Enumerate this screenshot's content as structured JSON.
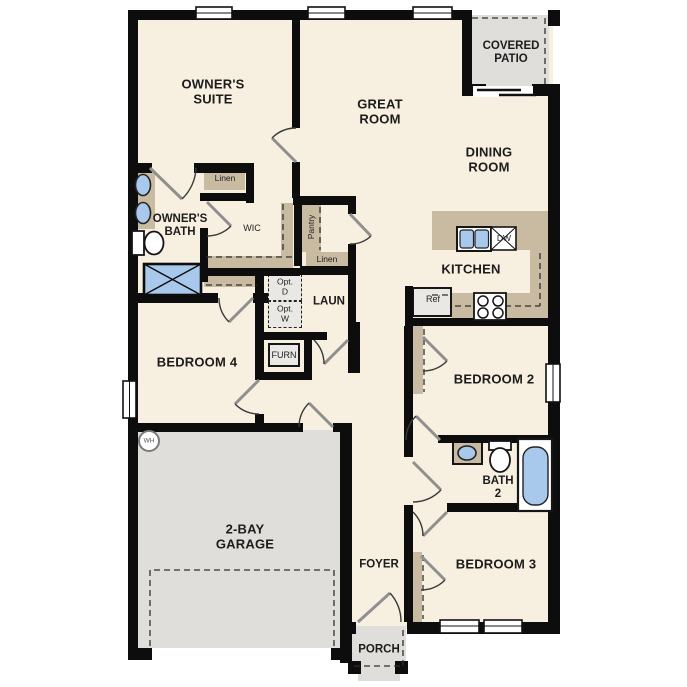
{
  "plan": {
    "name": "Single-story home floor plan",
    "rooms": {
      "owners_suite": "OWNER'S\nSUITE",
      "great_room": "GREAT\nROOM",
      "covered_patio": "COVERED\nPATIO",
      "dining_room": "DINING\nROOM",
      "owners_bath": "OWNER'S\nBATH",
      "wic": "WIC",
      "kitchen": "KITCHEN",
      "laundry": "LAUN",
      "bedroom4": "BEDROOM 4",
      "garage": "2-BAY\nGARAGE",
      "bedroom2": "BEDROOM 2",
      "bath2": "BATH\n2",
      "bedroom3": "BEDROOM 3",
      "foyer": "FOYER",
      "porch": "PORCH"
    },
    "closets": {
      "linen1": "Linen",
      "linen2": "Linen",
      "pantry": "Pantry"
    },
    "fixtures": {
      "furnace": "FURN",
      "refrigerator": "Ref",
      "dishwasher": "DW",
      "water_heater": "WH",
      "opt_dryer": "Opt.\nD",
      "opt_washer": "Opt.\nW"
    },
    "colors": {
      "floor_cream": "#f7efe0",
      "wall_black": "#0d0d0d",
      "counter_tan": "#c9baa2",
      "concrete_gray": "#e0dedb",
      "fixture_blue": "#a9c9ec",
      "appliance_gray": "#e9e8e5"
    }
  }
}
